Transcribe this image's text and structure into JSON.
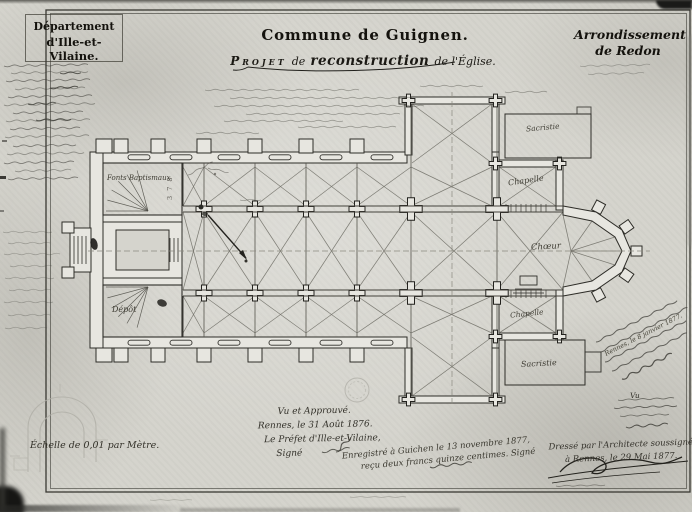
{
  "titles": {
    "department_line1": "Département",
    "department_line2": "d'Ille-et-Vilaine.",
    "commune": "Commune de Guignen.",
    "project_word": "Projet",
    "project_de": "de",
    "project_reconstruction": "reconstruction",
    "project_tail": "de l'Église.",
    "arrondissement_line1": "Arrondissement",
    "arrondissement_line2": "de Redon"
  },
  "plan_labels": {
    "fonts_baptismaux": "Fonts Baptismaux",
    "depot": "Dépôt",
    "sacristie_nord": "Sacristie",
    "chapelle_nord": "Chapelle",
    "choeur": "Chœur",
    "chapelle_sud": "Chapelle",
    "sacristie_sud": "Sacristie",
    "pencil_figures": "3 7 8"
  },
  "annotations": {
    "scale_note": "Échelle de 0,01 par Mètre.",
    "approval_line1": "Vu et Approuvé.",
    "approval_line2": "Rennes, le 31 Août 1876.",
    "approval_line3": "Le Préfet d'Ille-et-Vilaine,",
    "approval_line4": "Signé",
    "registration_line1": "Enregistré à Guichen le 13 novembre 1877,",
    "registration_line2": "reçu deux francs quinze centimes. Signé",
    "margin_note_date": "Rennes, le 8 janvier 1877.",
    "vu_label": "Vu",
    "architect_line1": "Dressé par l'Architecte soussigné",
    "architect_line2": "à Rennes, le 29 Mai 1877."
  }
}
